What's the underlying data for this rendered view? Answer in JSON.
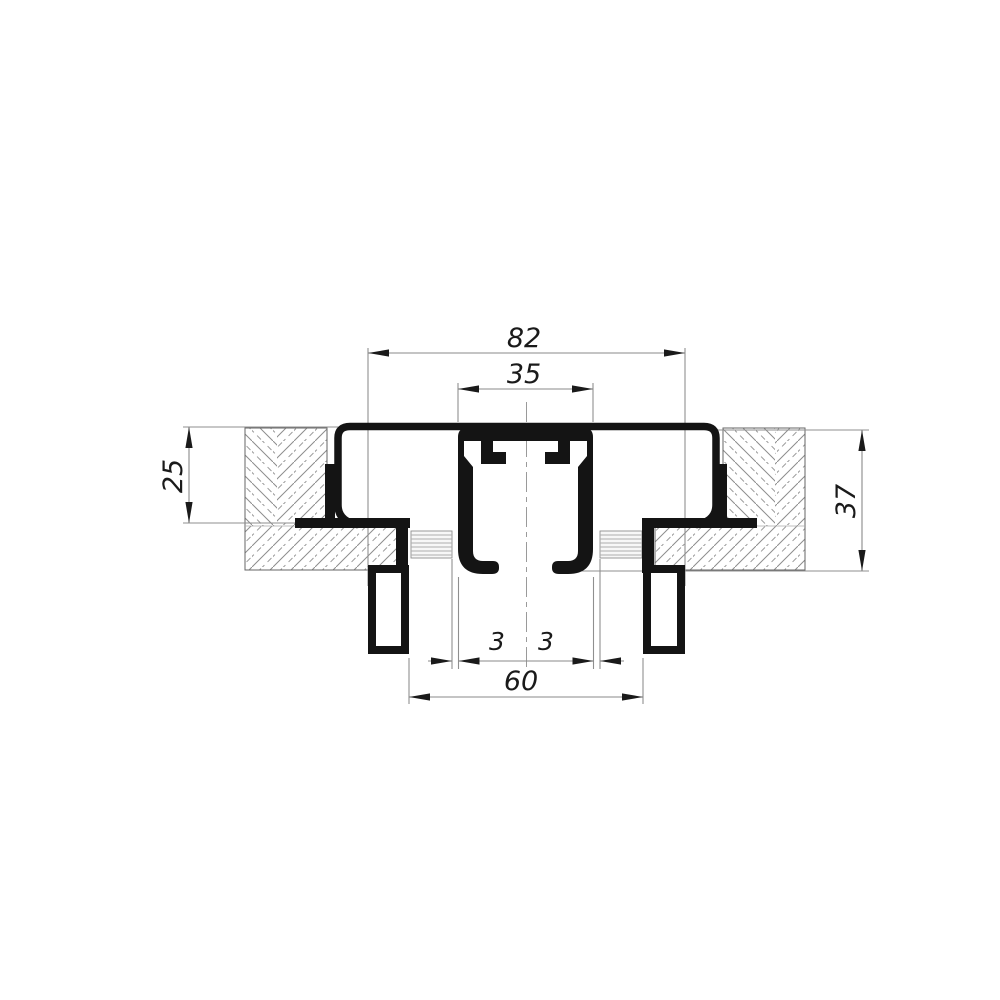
{
  "colors": {
    "ink": "#1a1a1a",
    "dim_line": "#8a8a8a",
    "hatch": "#8c8c8c",
    "background": "#ffffff"
  },
  "dimensions": {
    "overall_width": "82",
    "track_width": "35",
    "left_depth": "25",
    "right_depth": "37",
    "gap_left": "3",
    "gap_right": "3",
    "opening_width": "60"
  }
}
